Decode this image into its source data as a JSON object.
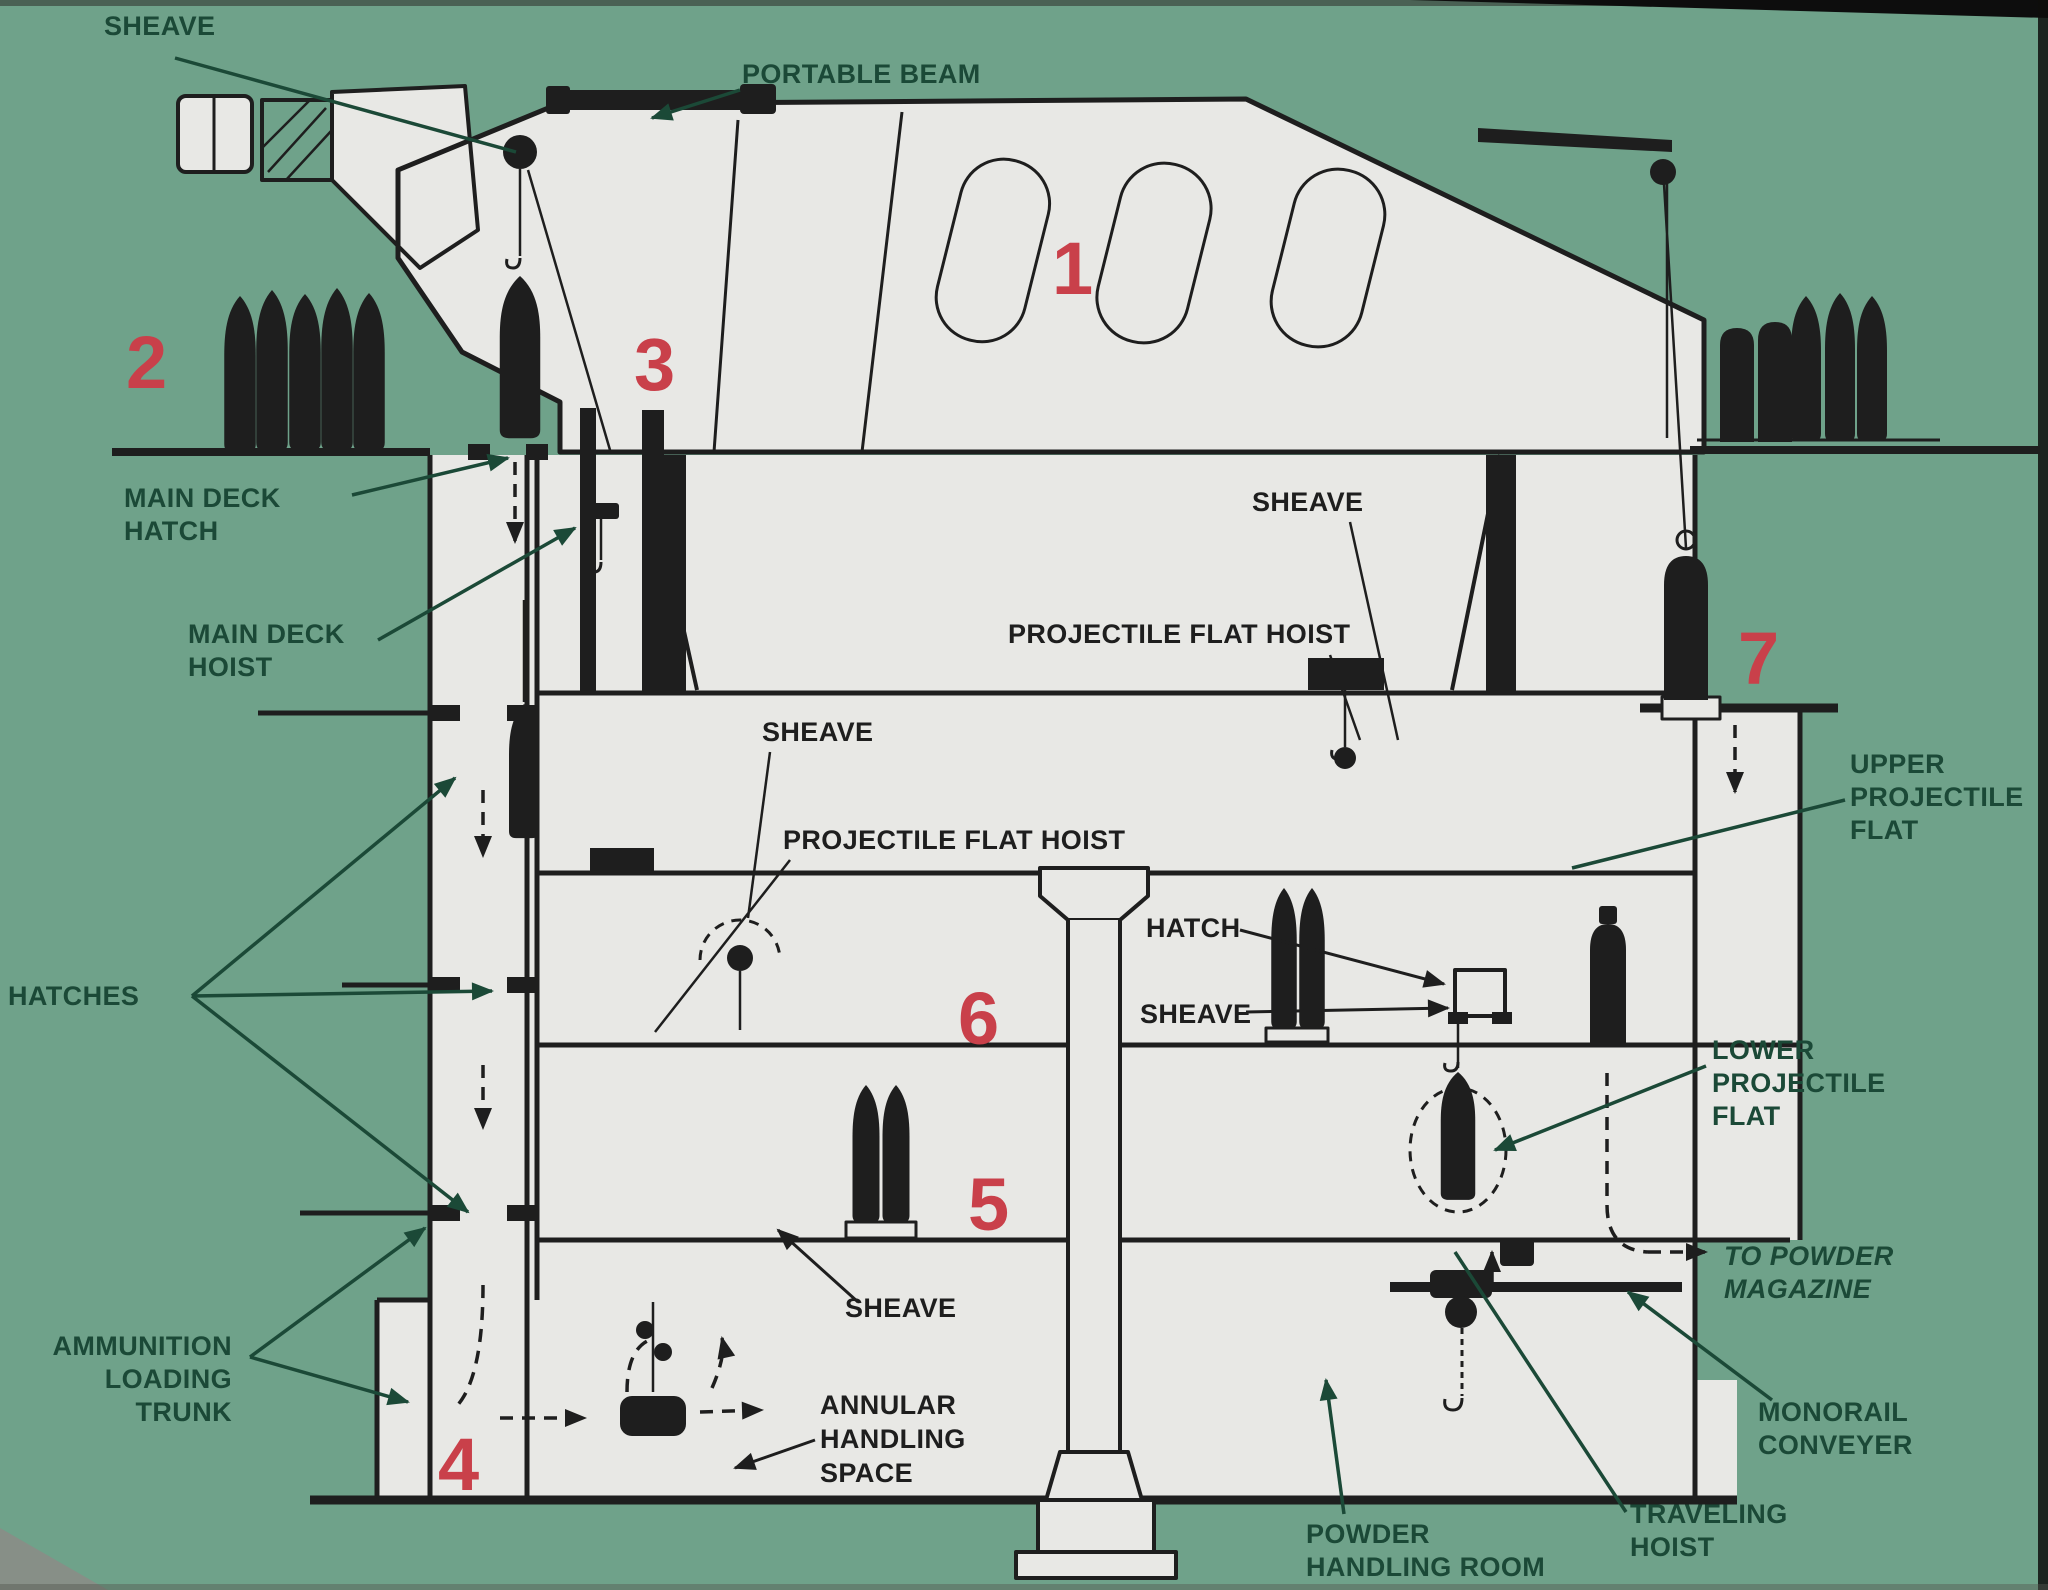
{
  "figure": {
    "type": "cross-section-diagram",
    "subject": "Naval gun turret ammunition handling system",
    "background_color": "#6FA28A",
    "panel_color": "#E8E8E5",
    "line_color": "#1E1E1E",
    "label_color": "#1B4937",
    "callout_number_color": "#C9404A"
  },
  "labels": {
    "sheave_top": "SHEAVE",
    "portable_beam": "PORTABLE BEAM",
    "main_deck_hatch": [
      "MAIN DECK",
      "HATCH"
    ],
    "main_deck_hoist": [
      "MAIN DECK",
      "HOIST"
    ],
    "sheave_turret": "SHEAVE",
    "projectile_flat_hoist_right": "PROJECTILE FLAT HOIST",
    "sheave_pan": "SHEAVE",
    "projectile_flat_hoist_left": "PROJECTILE FLAT HOIST",
    "hatch": "HATCH",
    "sheave_flat": "SHEAVE",
    "hatches": "HATCHES",
    "upper_projectile_flat": [
      "UPPER",
      "PROJECTILE",
      "FLAT"
    ],
    "lower_projectile_flat": [
      "LOWER",
      "PROJECTILE",
      "FLAT"
    ],
    "to_powder_magazine": [
      "TO POWDER",
      "MAGAZINE"
    ],
    "monorail_conveyer": [
      "MONORAIL",
      "CONVEYER"
    ],
    "traveling_hoist": [
      "TRAVELING",
      "HOIST"
    ],
    "powder_handling_room": [
      "POWDER",
      "HANDLING ROOM"
    ],
    "annular_handling_space": [
      "ANNULAR",
      "HANDLING",
      "SPACE"
    ],
    "ammunition_loading_trunk": [
      "AMMUNITION",
      "LOADING",
      "TRUNK"
    ],
    "sheave_annular": "SHEAVE",
    "numbers": [
      "1",
      "2",
      "3",
      "4",
      "5",
      "6",
      "7"
    ]
  }
}
